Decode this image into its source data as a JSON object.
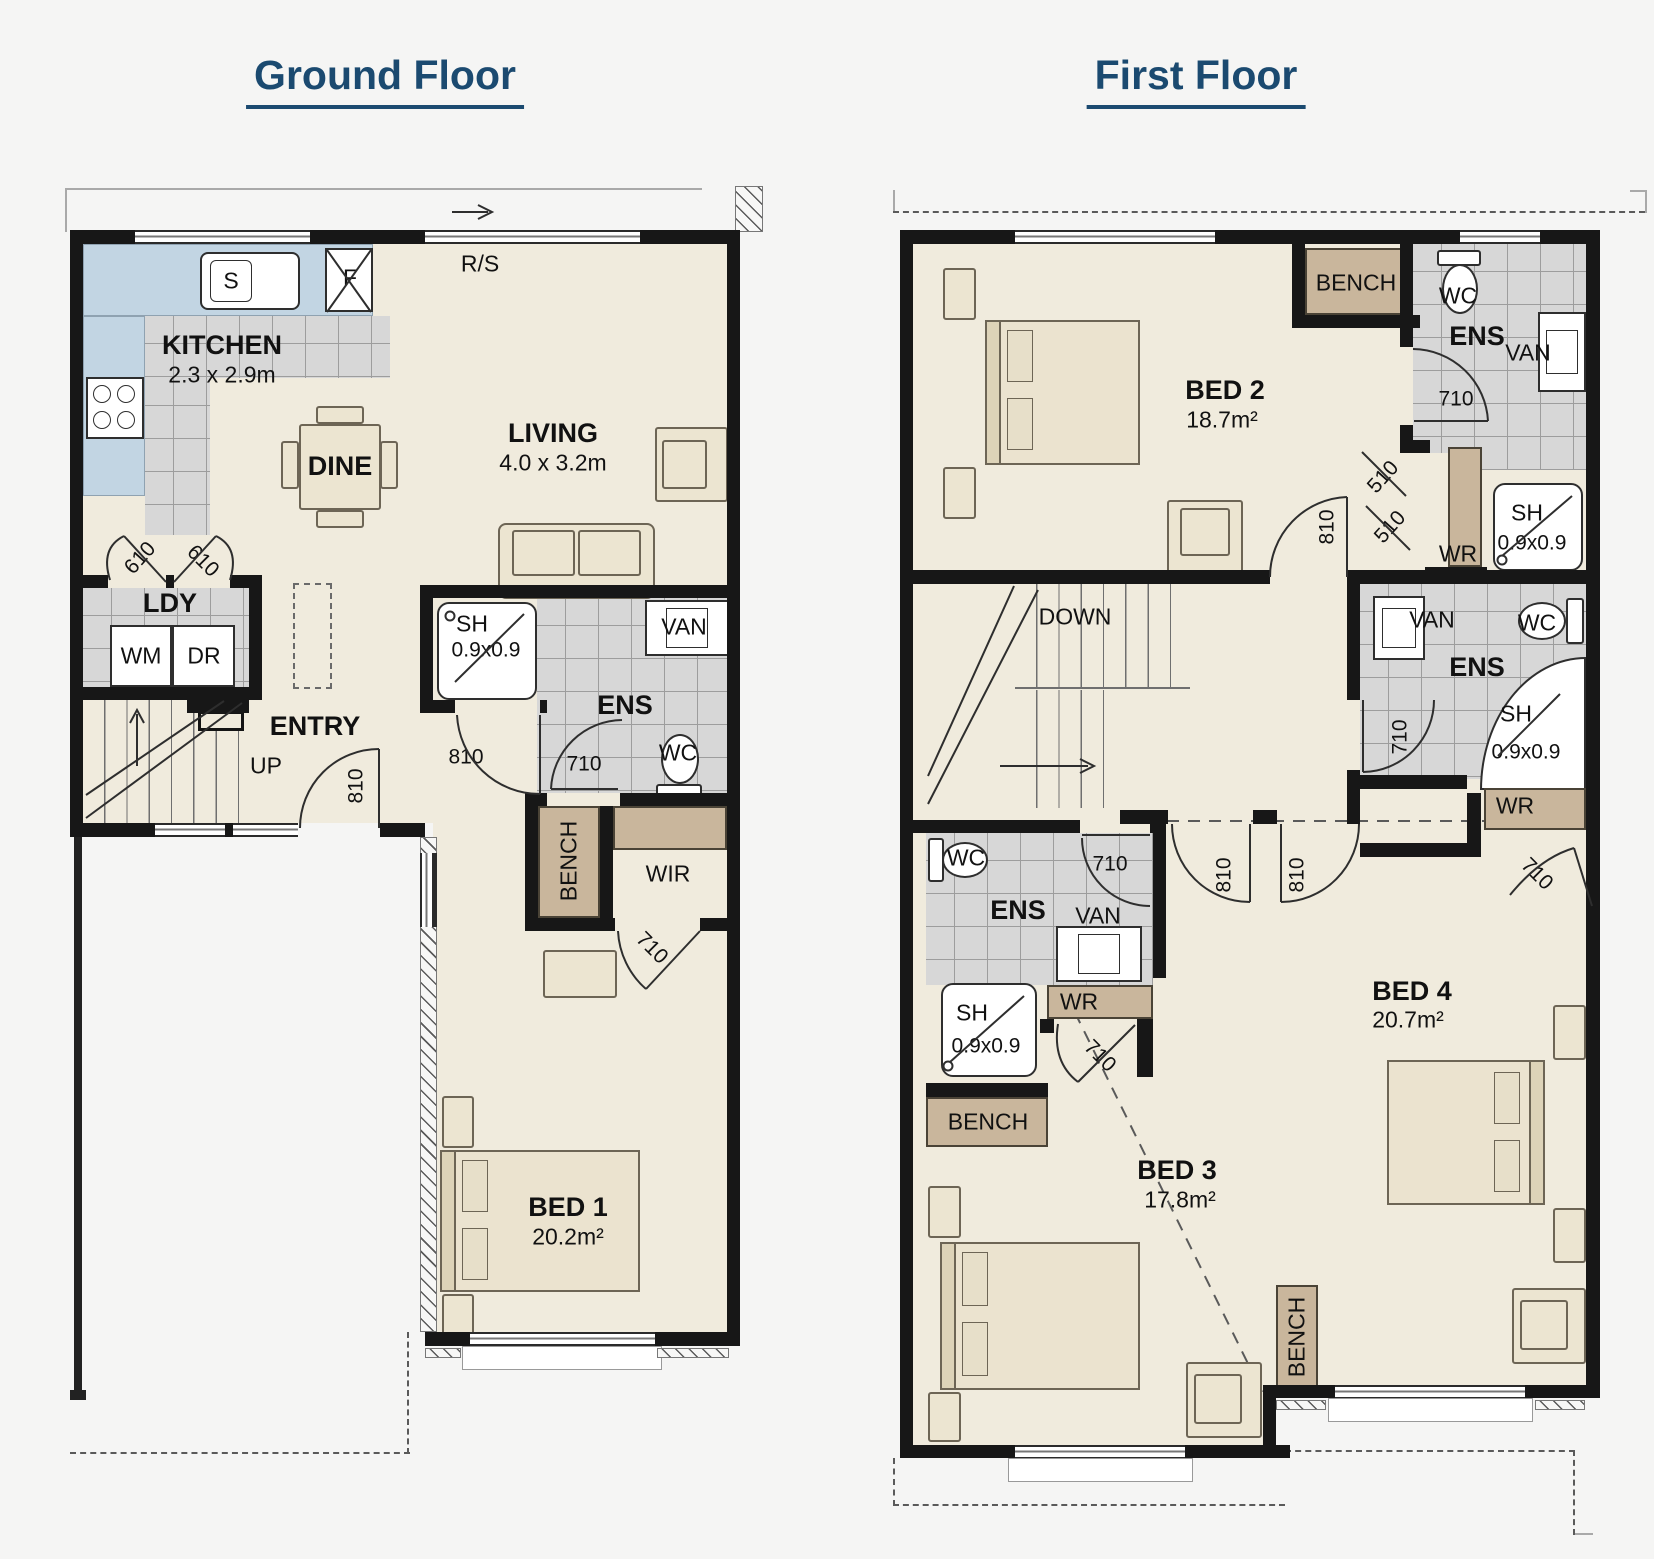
{
  "document": {
    "background": "#f5f5f4"
  },
  "colors": {
    "title_navy": "#1b4a70",
    "wall_black": "#171717",
    "floor_cream": "#f0ebdd",
    "tile_gray": "#d7d7d7",
    "counter_blue": "#c2d5e3",
    "joinery_tan": "#c9b69c"
  },
  "ground_floor": {
    "title": "Ground Floor",
    "labels": {
      "roof_slope": "R/S",
      "sink": "S",
      "fridge": "F",
      "kitchen": "KITCHEN",
      "kitchen_size": "2.3 x 2.9m",
      "dine": "DINE",
      "living": "LIVING",
      "living_size": "4.0 x 3.2m",
      "laundry": "LDY",
      "washer": "WM",
      "dryer": "DR",
      "entry": "ENTRY",
      "up": "UP",
      "ensuite": "ENS",
      "toilet": "WC",
      "vanity": "VAN",
      "shower": "SH",
      "shower_size": "0.9x0.9",
      "bench": "BENCH",
      "robe": "WIR",
      "bed1": "BED 1",
      "bed1_area": "20.2m²",
      "door_610": "610",
      "door_710": "710",
      "door_810": "810"
    }
  },
  "first_floor": {
    "title": "First Floor",
    "labels": {
      "down": "DOWN",
      "bed2": "BED 2",
      "bed2_area": "18.7m²",
      "bed3": "BED 3",
      "bed3_area": "17.8m²",
      "bed4": "BED 4",
      "bed4_area": "20.7m²",
      "ensuite": "ENS",
      "toilet": "WC",
      "vanity": "VAN",
      "shower": "SH",
      "shower_size": "0.9x0.9",
      "bench": "BENCH",
      "robe": "WR",
      "door_510": "510",
      "door_710": "710",
      "door_810": "810"
    }
  }
}
